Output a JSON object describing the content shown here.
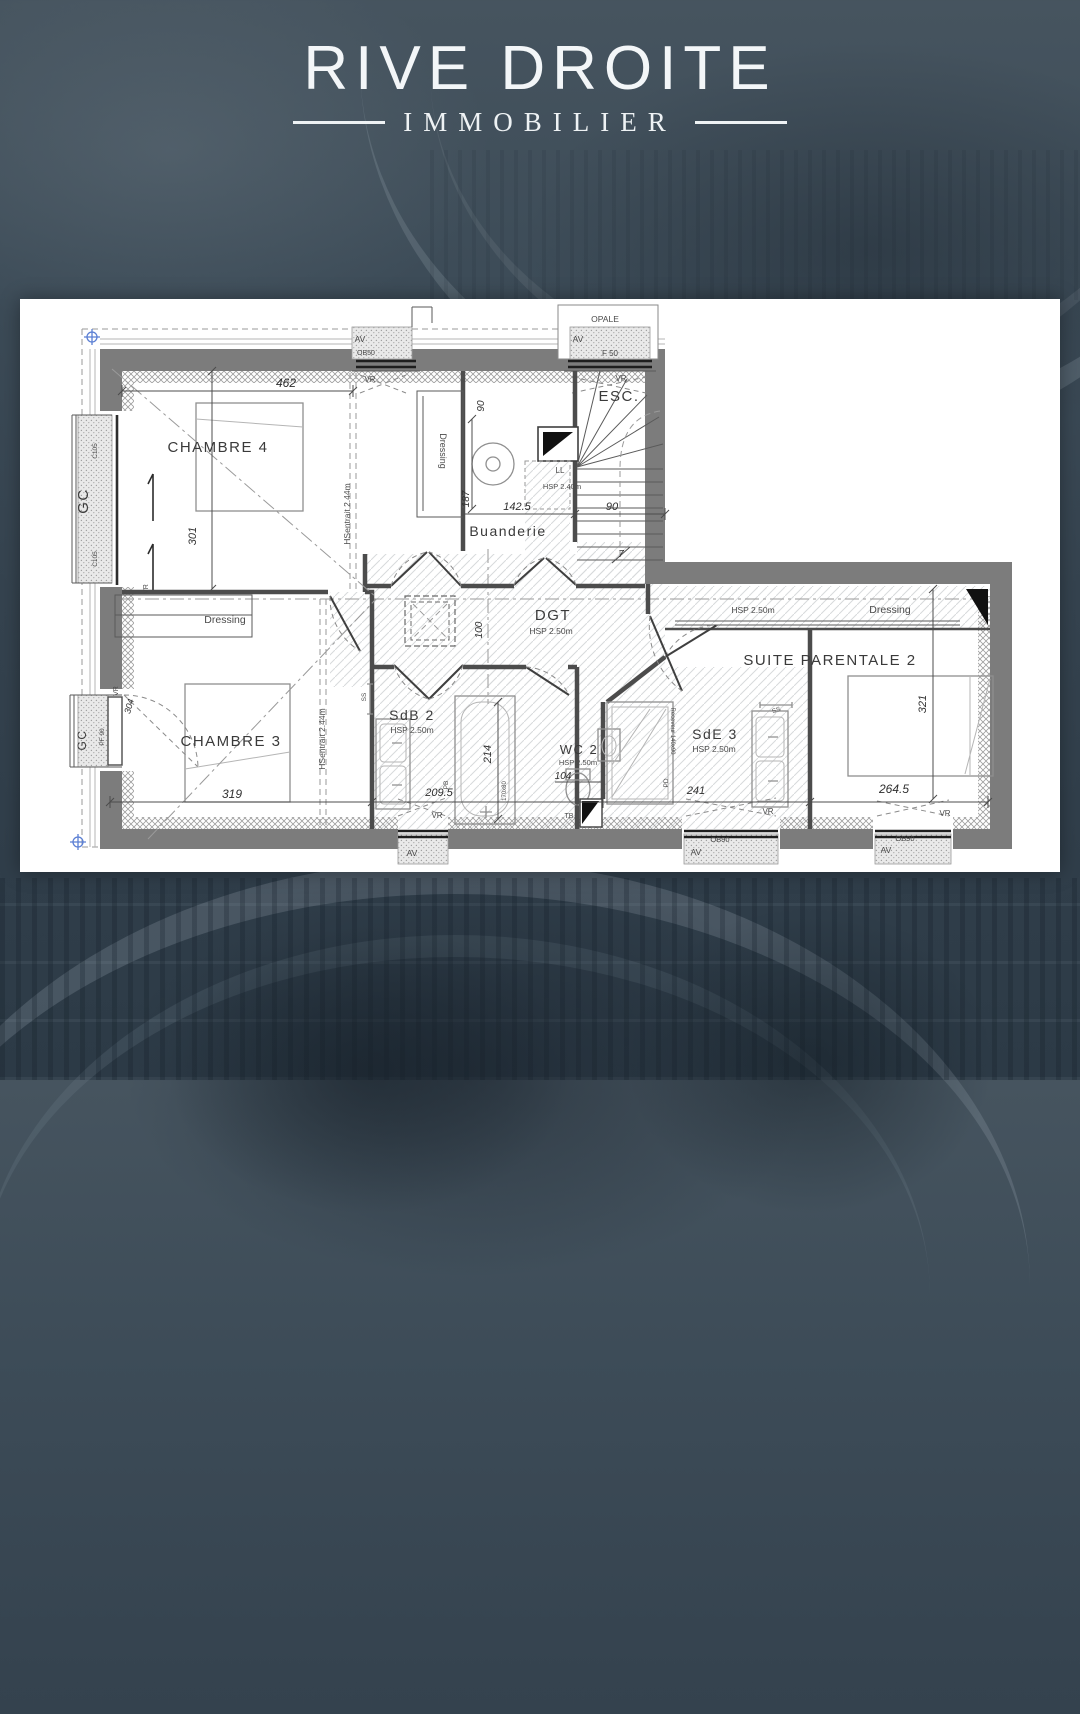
{
  "logo": {
    "title": "RIVE DROITE",
    "subtitle": "IMMOBILIER"
  },
  "plan": {
    "rooms": {
      "chambre4": "CHAMBRE 4",
      "chambre3": "CHAMBRE 3",
      "buanderie": "Buanderie",
      "esc": "ESC.",
      "dgt": "DGT",
      "sdb2": "SdB 2",
      "wc2": "WC 2",
      "sde3": "SdE 3",
      "suite": "SUITE PARENTALE 2",
      "dressing": "Dressing"
    },
    "heights": {
      "hsp250": "HSP 2.50m",
      "hsp240": "HSP 2.40m",
      "hsentrait": "HSentrait 2.44m"
    },
    "dims": {
      "d462": "462",
      "d301": "301",
      "d90": "90",
      "d187": "187",
      "d1425": "142.5",
      "d100": "100",
      "d304": "304",
      "d319": "319",
      "d214": "214",
      "d2095": "209.5",
      "d104": "104",
      "d241": "241",
      "d2645": "264.5",
      "d321": "321",
      "d7": "7"
    },
    "tags": {
      "av": "AV",
      "vr": "VR",
      "gc": "GC",
      "ll": "LL",
      "tb": "TB",
      "pb": "PB",
      "ss": "SS",
      "pd": "PD",
      "opale": "OPALE",
      "f50": "F 50",
      "ob50": "OB50",
      "ob90": "OB90",
      "pf90": "PF 90",
      "c105": "C105",
      "receveur": "Receveur 140x90",
      "tub": "170x80"
    }
  }
}
